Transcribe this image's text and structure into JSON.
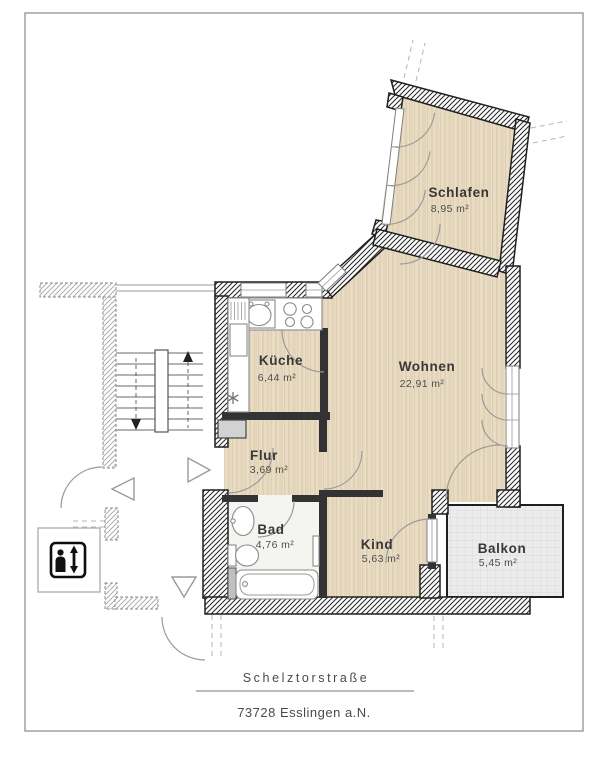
{
  "address": {
    "street": "Schelztorstraße",
    "city": "73728 Esslingen a.N."
  },
  "rooms": {
    "schlafen": {
      "name": "Schlafen",
      "area": "8,95 m²"
    },
    "kueche": {
      "name": "Küche",
      "area": "6,44 m²"
    },
    "wohnen": {
      "name": "Wohnen",
      "area": "22,91 m²"
    },
    "flur": {
      "name": "Flur",
      "area": "3,69 m²"
    },
    "bad": {
      "name": "Bad",
      "area": "4,76 m²"
    },
    "kind": {
      "name": "Kind",
      "area": "5,63 m²"
    },
    "balkon": {
      "name": "Balkon",
      "area": "5,45 m²"
    }
  },
  "symbols": {
    "elevator": "person with up/down arrows",
    "stairs_up": "↑",
    "stairs_down": "↓"
  },
  "colors": {
    "floor_wood": "#e9dcc2",
    "floor_bath": "#f4f4f1",
    "balcony": "#ececec",
    "wall_dark": "#1f1f1f",
    "line_gray": "#9a9a9a"
  }
}
